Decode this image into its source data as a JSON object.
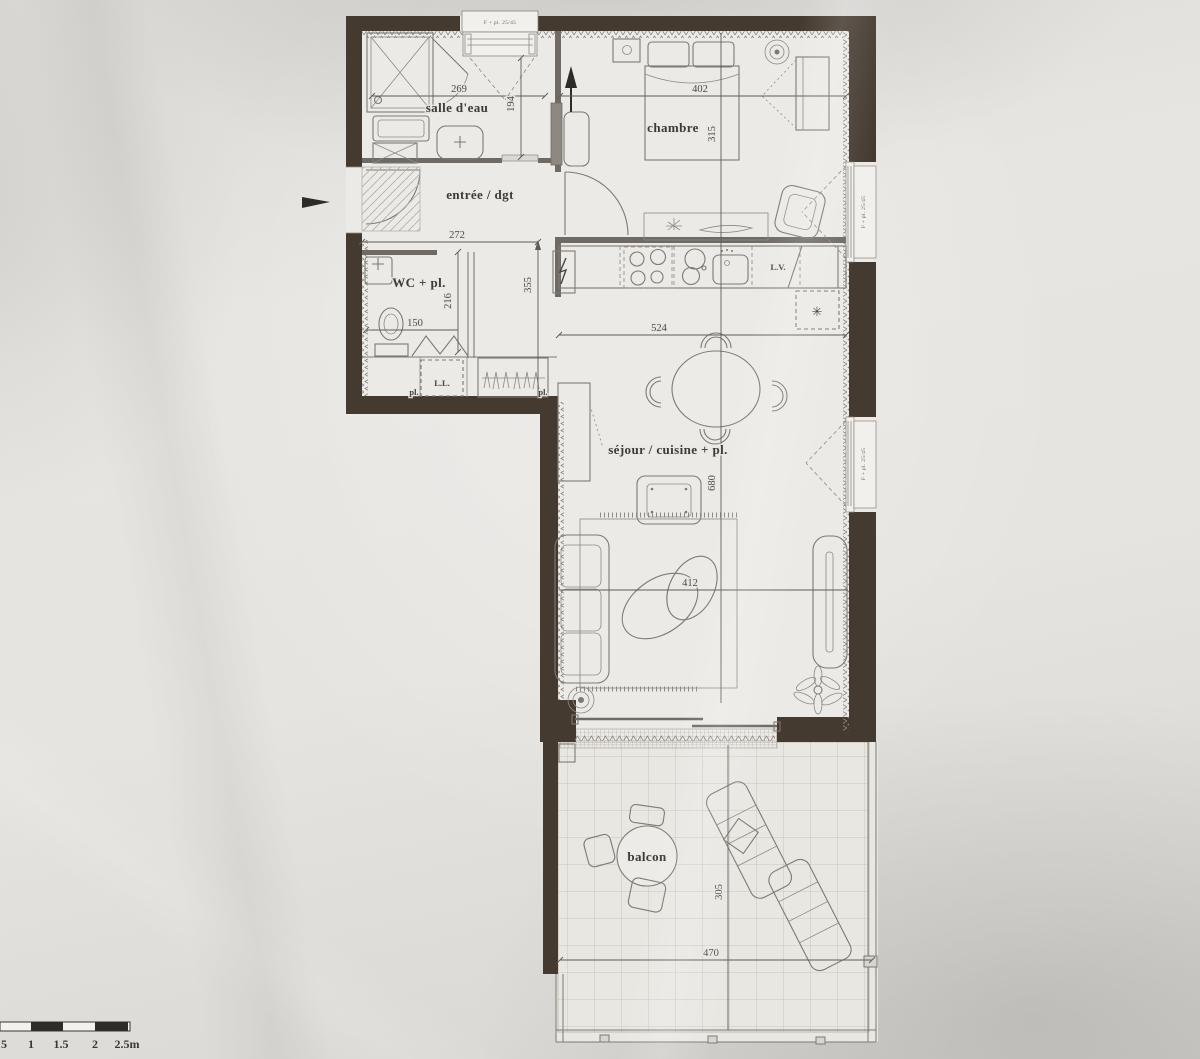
{
  "plan": {
    "rooms": {
      "salle_deau": "salle d'eau",
      "entree": "entrée / dgt",
      "wc": "WC + pl.",
      "chambre": "chambre",
      "sejour": "séjour / cuisine + pl.",
      "balcon": "balcon"
    },
    "labels": {
      "dishwasher": "L.V.",
      "washing_machine": "L.L.",
      "closet_left": "pl.",
      "closet_right": "pl."
    },
    "dimensions_cm": {
      "salle_deau_w": "269",
      "salle_deau_d": "194",
      "entree_w": "272",
      "hall_d": "355",
      "wc_d": "216",
      "wc_w": "150",
      "chambre_w": "402",
      "chambre_d": "315",
      "cuisine_w": "524",
      "sejour_d": "680",
      "sejour_w": "412",
      "balcon_w": "470",
      "balcon_d": "305"
    },
    "window_tags": {
      "top": "F + pl. 25/45",
      "right_upper": "F + pl. 25/45",
      "right_lower": "F + pl. 25/45"
    },
    "glyphs": {
      "fridge_snowflake": "✳"
    },
    "scale_bar": {
      "labels": [
        "5",
        "1",
        "1.5",
        "2",
        "2.5m"
      ]
    },
    "colors": {
      "wall": "#443a30",
      "ink": "#3e3b37",
      "paper": "#e6e4e0"
    }
  }
}
